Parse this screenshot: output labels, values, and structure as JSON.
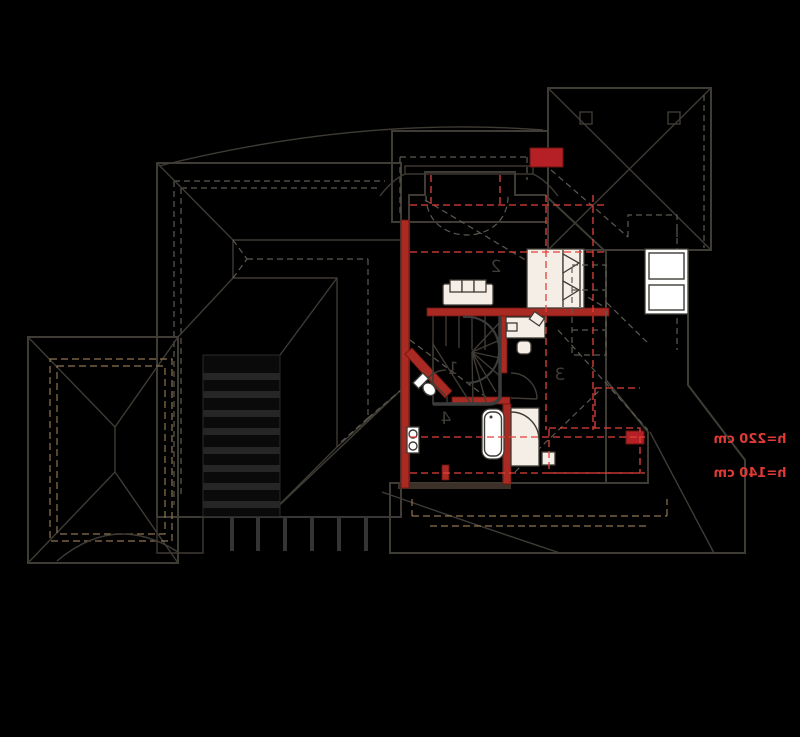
{
  "plan": {
    "title": "attic-floor-plan-mirrored",
    "rooms": [
      {
        "label": "1"
      },
      {
        "label": "2"
      },
      {
        "label": "3"
      },
      {
        "label": "4"
      }
    ],
    "annotations": {
      "height_upper": "h=220 cm",
      "height_lower": "h=140 cm"
    },
    "colors": {
      "background": "#000000",
      "roof": "#bf9a6b",
      "roof_line": "#3f3b35",
      "flat_roof": "#f2f2f2",
      "floor": "#ecdfd6",
      "recess_floor": "#f6efe3",
      "bathroom_floor": "#d9ebfa",
      "wall_red": "#a82a22",
      "chimney_red": "#b42025",
      "dashed_red": "#e2403a",
      "annotation_red": "#e03a36",
      "label_dark": "#3f3b35",
      "pergola_black": "#0a0a0a"
    }
  }
}
